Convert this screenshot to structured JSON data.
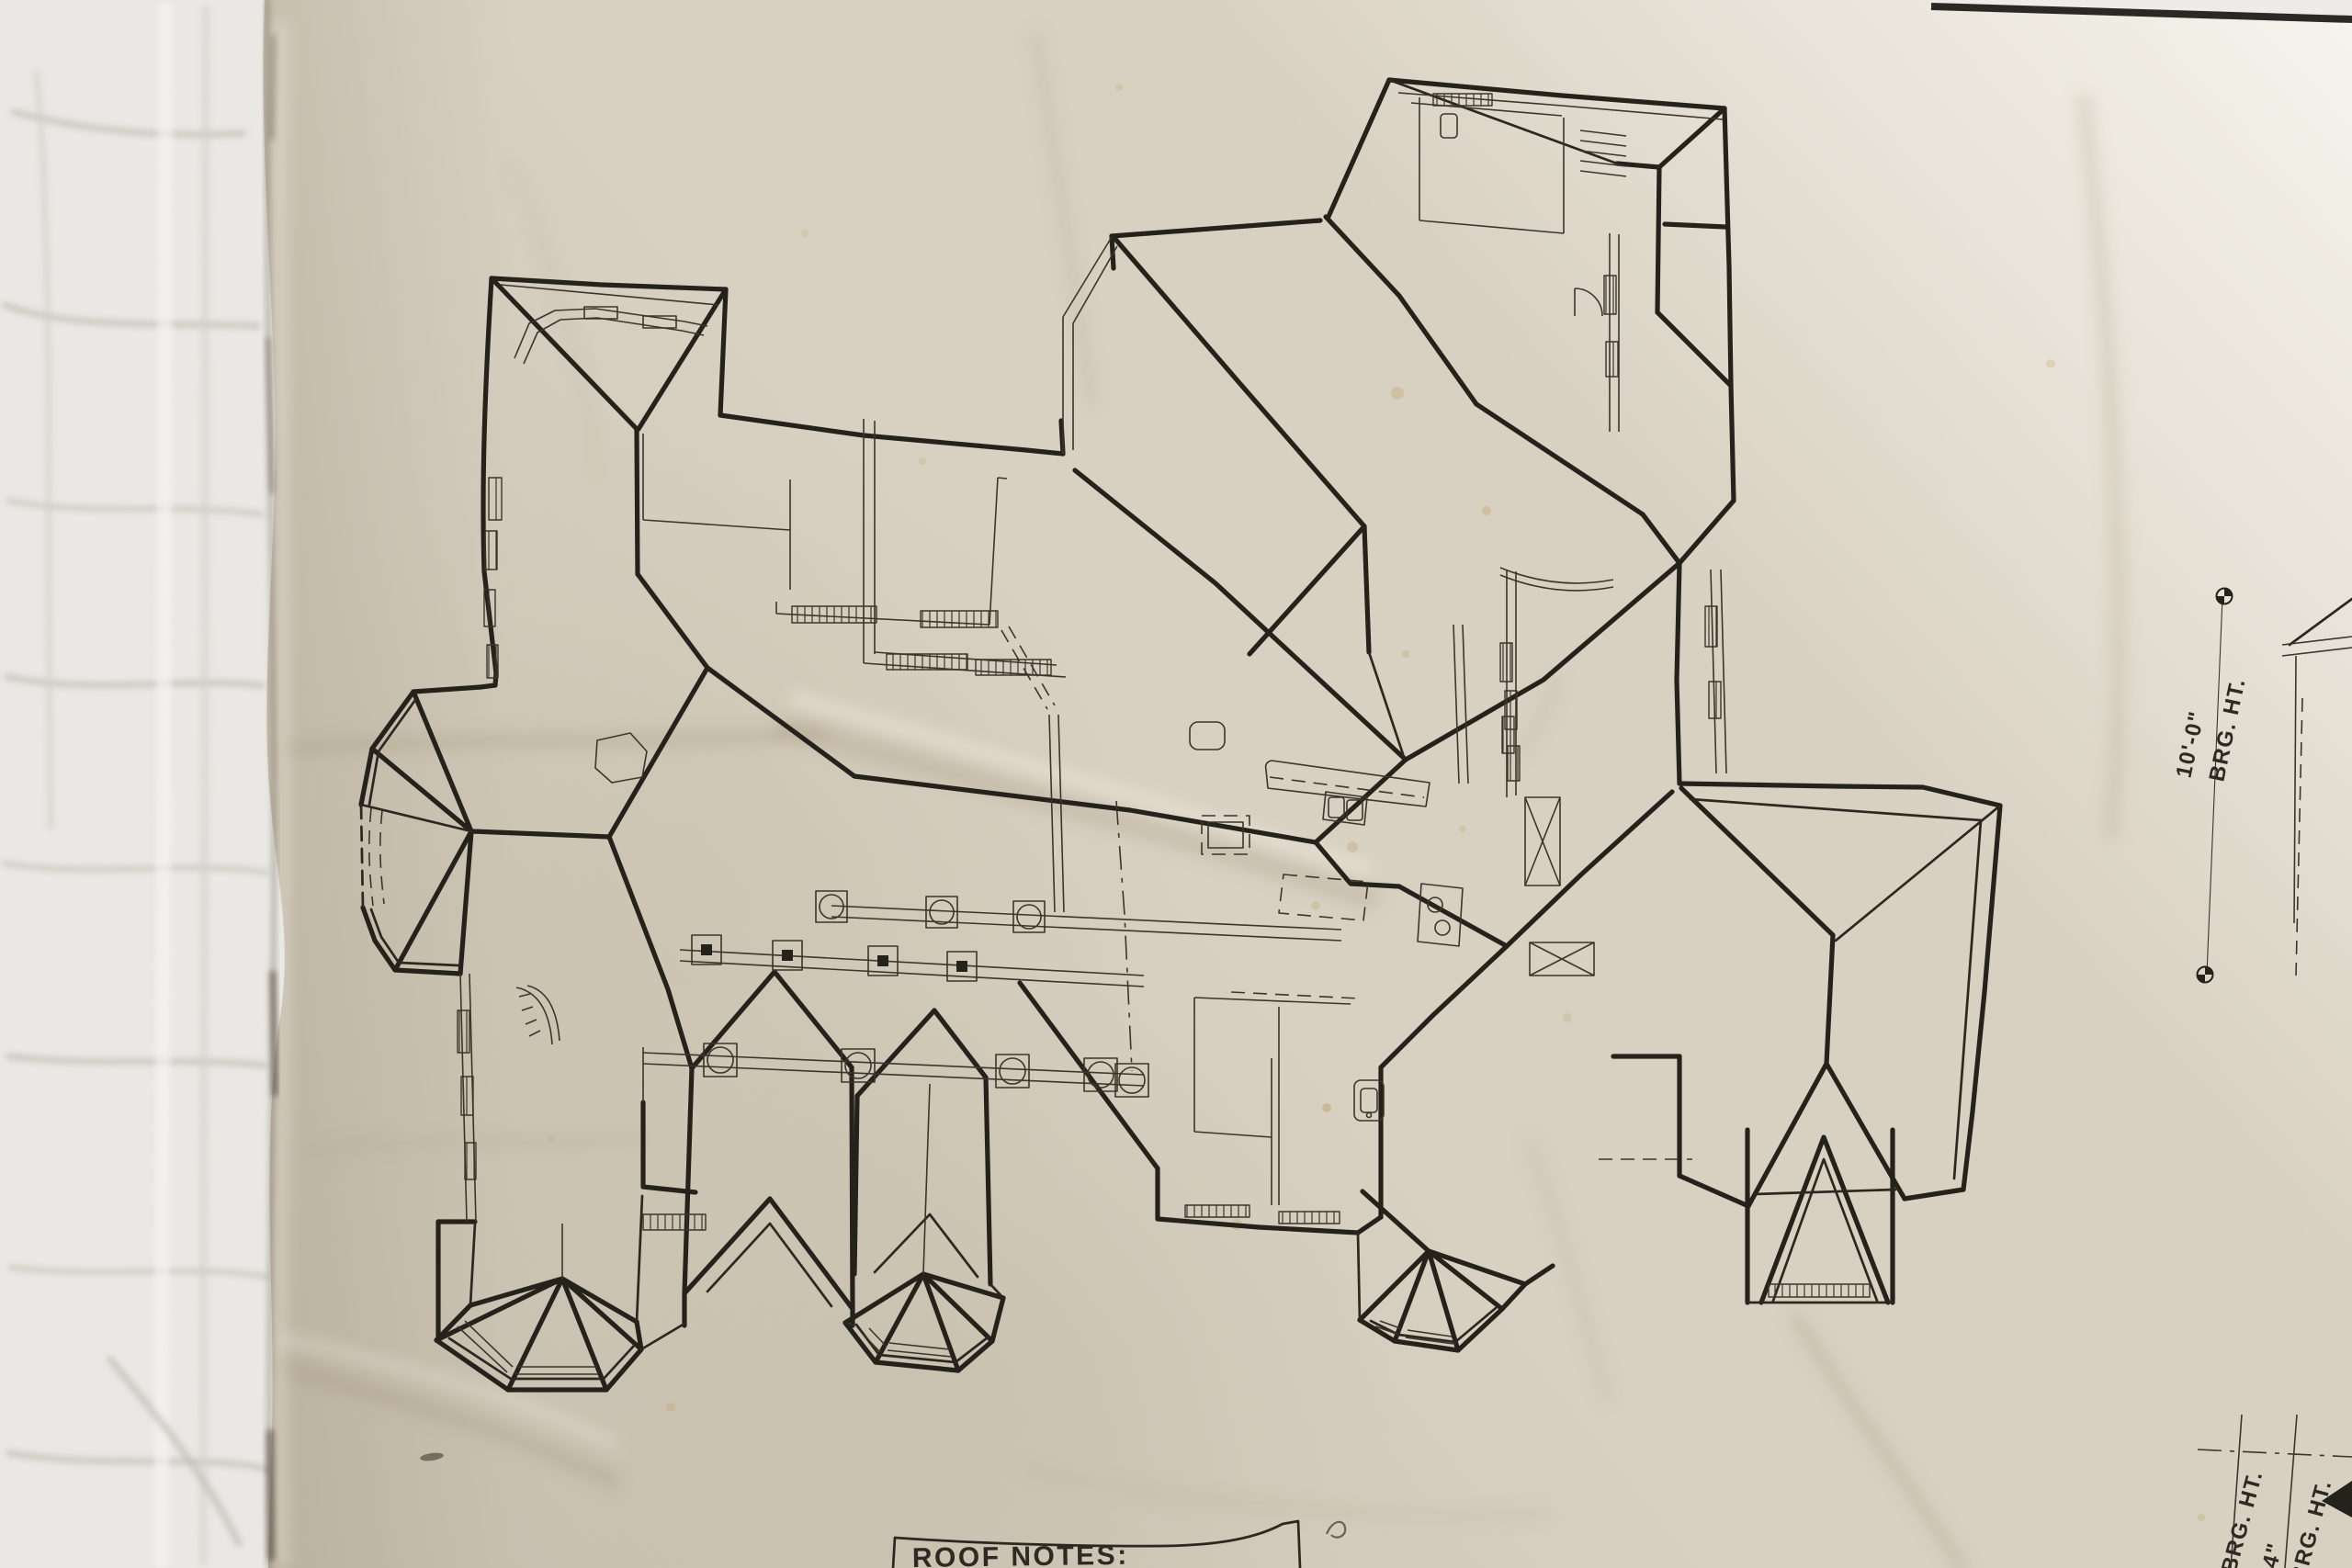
{
  "drawing": {
    "kind": "roof plan blueprint photograph",
    "notes_box": {
      "title": "ROOF NOTES:"
    },
    "dimensions": {
      "right_elevation": {
        "value": "10'-0\"",
        "label": "BRG. HT."
      },
      "bottom_right": [
        {
          "label": "BRG. HT."
        },
        {
          "value": "11'-4\""
        },
        {
          "label": "BRG. HT."
        }
      ]
    }
  },
  "colors": {
    "ink": "#25211b",
    "paper": "#d8d1c2",
    "paper_highlight": "#f2efe8",
    "underlay_sheet": "#eae8e4",
    "crease_shadow": "#8d8272"
  }
}
